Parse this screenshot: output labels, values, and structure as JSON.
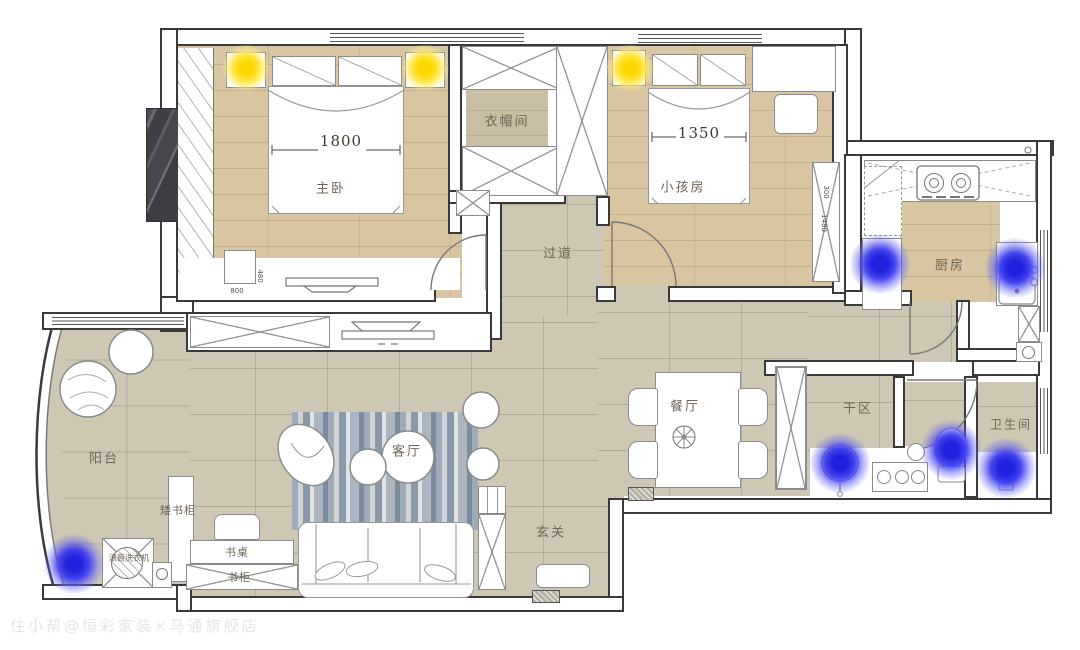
{
  "watermark": "住小帮@恒彩家装×马通旗舰店",
  "rooms": {
    "master_bedroom": {
      "label": "主卧",
      "bed_width_mm": "1800",
      "dresser_width_mm": "800",
      "dresser_depth_mm": "480"
    },
    "cloakroom": {
      "label": "衣帽间"
    },
    "kids_room": {
      "label": "小孩房",
      "bed_width_mm": "1350",
      "cabinet_depth_mm": "300",
      "cabinet_length_mm": "1480"
    },
    "hallway": {
      "label": "过道"
    },
    "kitchen": {
      "label": "厨房"
    },
    "dining_room": {
      "label": "餐厅"
    },
    "dry_area": {
      "label": "干区"
    },
    "bathroom": {
      "label": "卫生间"
    },
    "balcony": {
      "label": "阳台"
    },
    "living_room": {
      "label": "客厅"
    },
    "entryway": {
      "label": "玄关"
    }
  },
  "furniture_labels": {
    "low_bookcase": "矮书柜",
    "desk": "书桌",
    "bookcase": "书柜",
    "washing_machine": "滚筒洗衣机"
  },
  "lighting": {
    "ceiling_warm_lights": 3,
    "spot_cool_lights": 6,
    "warm_color": "#ffd800",
    "cool_color": "#2d2df0"
  },
  "palette": {
    "wood_floor": "#d8c6a3",
    "tile_floor": "#cdc7b4",
    "closet_floor": "#c9bda4",
    "wall_outline": "#3a3a3a",
    "rug_blue_gray": "#9fb0c2",
    "bay_marble": "#56565c"
  }
}
